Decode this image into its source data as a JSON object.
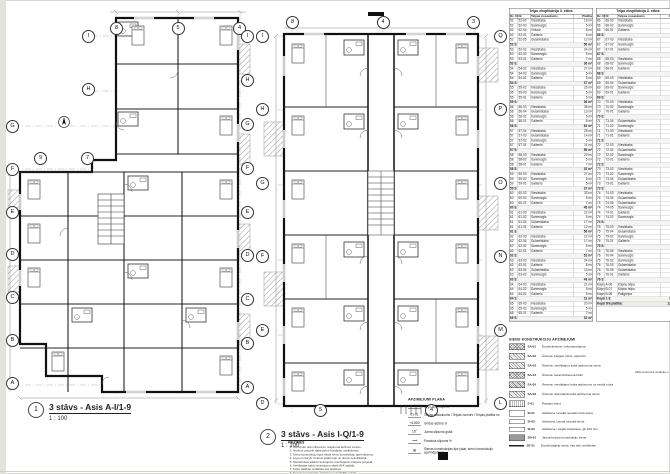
{
  "plan1": {
    "num": "1",
    "title": "3 stāvs - Asis A-I/1-9",
    "scale": "1 : 100",
    "bubbles_top": [
      "8",
      "5",
      "4"
    ],
    "bubbles_mid": [
      "9",
      "7"
    ],
    "bubbles_left_upper": [
      "I",
      "H"
    ],
    "bubbles_left": [
      "G",
      "F",
      "E",
      "D",
      "C",
      "B",
      "A"
    ],
    "bubbles_right": [
      "I",
      "H",
      "G",
      "F",
      "E",
      "D",
      "C",
      "B",
      "A"
    ]
  },
  "plan2": {
    "num": "2",
    "title": "3 stāvs - Asis I-Q/1-9",
    "scale": "1 : 100",
    "bubbles_top": [
      "8",
      "4",
      "3"
    ],
    "bubbles_left": [
      "I",
      "H",
      "G",
      "F",
      "E",
      "D"
    ],
    "bubbles_right": [
      "Q",
      "P",
      "O",
      "N",
      "M",
      "L"
    ],
    "bubbles_bottom": [
      "5",
      "4"
    ]
  },
  "tables": {
    "title": "Telpu eksplikācija 3. stāvs",
    "cols": [
      "Dz. Nr",
      "Nr",
      "Telpas nosaukums",
      "Platība"
    ],
    "rows1": [
      {
        "a": "52",
        "b": "52-02",
        "c": "Viesistaba",
        "d": "19 m²"
      },
      {
        "a": "52",
        "b": "52-03",
        "c": "Sanmezgls",
        "d": "5 m²"
      },
      {
        "a": "52",
        "b": "52-04",
        "c": "Virtuve",
        "d": "8 m²"
      },
      {
        "a": "52",
        "b": "52-01",
        "c": "Gaitenis",
        "d": "6 m²"
      },
      {
        "a": "52",
        "b": "52-05",
        "c": "Guļamistaba",
        "d": "12 m²"
      },
      {
        "a": "52 S:",
        "d": "50 m²",
        "t": "s"
      },
      {
        "a": "53",
        "b": "53-02",
        "c": "Viesistaba",
        "d": "24 m²"
      },
      {
        "a": "53",
        "b": "53-03",
        "c": "Sanmezgls",
        "d": "5 m²"
      },
      {
        "a": "53",
        "b": "53-01",
        "c": "Gaitenis",
        "d": "7 m²"
      },
      {
        "a": "53 S:",
        "d": "36 m²",
        "t": "s"
      },
      {
        "a": "54",
        "b": "54-02",
        "c": "Viesistaba",
        "d": "27 m²"
      },
      {
        "a": "54",
        "b": "54-03",
        "c": "Sanmezgls",
        "d": "5 m²"
      },
      {
        "a": "54",
        "b": "54-01",
        "c": "Gaitenis",
        "d": "5 m²"
      },
      {
        "a": "54 S:",
        "d": "37 m²",
        "t": "s"
      },
      {
        "a": "55",
        "b": "55-02",
        "c": "Viesistaba",
        "d": "26 m²"
      },
      {
        "a": "55",
        "b": "55-03",
        "c": "Sanmezgls",
        "d": "5 m²"
      },
      {
        "a": "55",
        "b": "55-01",
        "c": "Gaitenis",
        "d": "5 m²"
      },
      {
        "a": "55 S:",
        "d": "36 m²",
        "t": "s"
      },
      {
        "a": "56",
        "b": "56-03",
        "c": "Viesistaba",
        "d": "35 m²"
      },
      {
        "a": "56",
        "b": "56-04",
        "c": "Guļamistaba",
        "d": "13 m²"
      },
      {
        "a": "56",
        "b": "56-02",
        "c": "Sanmezgls",
        "d": "6 m²"
      },
      {
        "a": "56",
        "b": "56-01",
        "c": "Gaitenis",
        "d": "8 m²"
      },
      {
        "a": "56 S:",
        "d": "62 m²",
        "t": "s"
      },
      {
        "a": "57",
        "b": "57-04",
        "c": "Viesistaba",
        "d": "26 m²"
      },
      {
        "a": "57",
        "b": "57-03",
        "c": "Guļamistaba",
        "d": "14 m²"
      },
      {
        "a": "57",
        "b": "57-02",
        "c": "Sanmezgls",
        "d": "5 m²"
      },
      {
        "a": "57",
        "b": "57-01",
        "c": "Gaitenis",
        "d": "11 m²"
      },
      {
        "a": "57 S:",
        "d": "56 m²",
        "t": "s"
      },
      {
        "a": "58",
        "b": "58-03",
        "c": "Viesistaba",
        "d": "20 m²"
      },
      {
        "a": "58",
        "b": "58-02",
        "c": "Sanmezgls",
        "d": "5 m²"
      },
      {
        "a": "58",
        "b": "58-01",
        "c": "Gaitenis",
        "d": "7 m²"
      },
      {
        "a": "58 S:",
        "d": "32 m²",
        "t": "s"
      },
      {
        "a": "59",
        "b": "59-03",
        "c": "Viesistaba",
        "d": "27 m²"
      },
      {
        "a": "59",
        "b": "59-02",
        "c": "Sanmezgls",
        "d": "5 m²"
      },
      {
        "a": "59",
        "b": "59-01",
        "c": "Gaitenis",
        "d": "5 m²"
      },
      {
        "a": "59 S:",
        "d": "37 m²",
        "t": "s"
      },
      {
        "a": "60",
        "b": "60-03",
        "c": "Viesistaba",
        "d": "33 m²"
      },
      {
        "a": "60",
        "b": "60-02",
        "c": "Sanmezgls",
        "d": "5 m²"
      },
      {
        "a": "60",
        "b": "60-01",
        "c": "Gaitenis",
        "d": "7 m²"
      },
      {
        "a": "60 S:",
        "d": "45 m²",
        "t": "s"
      },
      {
        "a": "61",
        "b": "61-03",
        "c": "Viesistaba",
        "d": "22 m²"
      },
      {
        "a": "61",
        "b": "61-02",
        "c": "Sanmezgls",
        "d": "5 m²"
      },
      {
        "a": "61",
        "b": "61-04",
        "c": "Guļamistaba",
        "d": "17 m²"
      },
      {
        "a": "61",
        "b": "61-01",
        "c": "Gaitenis",
        "d": "12 m²"
      },
      {
        "a": "61 S:",
        "d": "56 m²",
        "t": "s"
      },
      {
        "a": "62",
        "b": "62-03",
        "c": "Viesistaba",
        "d": "22 m²"
      },
      {
        "a": "62",
        "b": "62-04",
        "c": "Guļamistaba",
        "d": "17 m²"
      },
      {
        "a": "62",
        "b": "62-02",
        "c": "Sanmezgls",
        "d": "5 m²"
      },
      {
        "a": "62",
        "b": "62-01",
        "c": "Gaitenis",
        "d": "7 m²"
      },
      {
        "a": "62 S:",
        "d": "51 m²",
        "t": "s"
      },
      {
        "a": "63",
        "b": "63-03",
        "c": "Viesistaba",
        "d": "24 m²"
      },
      {
        "a": "63",
        "b": "63-01",
        "c": "Gaitenis",
        "d": "8 m²"
      },
      {
        "a": "63",
        "b": "63-04",
        "c": "Guļamistaba",
        "d": "13 m²"
      },
      {
        "a": "63",
        "b": "63-02",
        "c": "Sanmezgls",
        "d": "5 m²"
      },
      {
        "a": "63 S:",
        "d": "49 m²",
        "t": "s"
      },
      {
        "a": "64",
        "b": "64-03",
        "c": "Viesistaba",
        "d": "21 m²"
      },
      {
        "a": "64",
        "b": "64-02",
        "c": "Sanmezgls",
        "d": "5 m²"
      },
      {
        "a": "64",
        "b": "64-01",
        "c": "Gaitenis",
        "d": "5 m²"
      },
      {
        "a": "64 S:",
        "d": "31 m²",
        "t": "s"
      },
      {
        "a": "65",
        "b": "65-03",
        "c": "Viesistaba",
        "d": "20 m²"
      },
      {
        "a": "65",
        "b": "65-02",
        "c": "Sanmezgls",
        "d": "5 m²"
      },
      {
        "a": "65",
        "b": "65-01",
        "c": "Gaitenis",
        "d": "7 m²"
      },
      {
        "a": "65 S:",
        "d": "32 m²",
        "t": "s"
      }
    ],
    "rows2": [
      {
        "a": "66",
        "b": "66-03",
        "c": "Viesistaba",
        "d": "20 m²"
      },
      {
        "a": "66",
        "b": "66-02",
        "c": "Sanmezgls",
        "d": "5 m²"
      },
      {
        "a": "66",
        "b": "66-01",
        "c": "Gaitenis",
        "d": "7 m²"
      },
      {
        "a": "66 S:",
        "d": "32 m²",
        "t": "s"
      },
      {
        "a": "67",
        "b": "67-03",
        "c": "Viesistaba",
        "d": "16 m²"
      },
      {
        "a": "67",
        "b": "67-02",
        "c": "Sanmezgls",
        "d": "4 m²"
      },
      {
        "a": "67",
        "b": "67-01",
        "c": "Gaitenis",
        "d": "3 m²"
      },
      {
        "a": "67 S:",
        "d": "23 m²",
        "t": "s"
      },
      {
        "a": "68",
        "b": "68-03",
        "c": "Viesistaba",
        "d": "19 m²"
      },
      {
        "a": "68",
        "b": "68-02",
        "c": "Sanmezgls",
        "d": "4 m²"
      },
      {
        "a": "68",
        "b": "68-01",
        "c": "Gaitenis",
        "d": "4 m²"
      },
      {
        "a": "68 S:",
        "d": "27 m²",
        "t": "s"
      },
      {
        "a": "69",
        "b": "69-03",
        "c": "Viesistaba",
        "d": "23 m²"
      },
      {
        "a": "69",
        "b": "69-04",
        "c": "Guļamistaba",
        "d": "11 m²"
      },
      {
        "a": "69",
        "b": "69-02",
        "c": "Sanmezgls",
        "d": "4 m²"
      },
      {
        "a": "69",
        "b": "69-01",
        "c": "Gaitenis",
        "d": "5 m²"
      },
      {
        "a": "69 S:",
        "d": "43 m²",
        "t": "s"
      },
      {
        "a": "70",
        "b": "70-03",
        "c": "Viesistaba",
        "d": "26 m²"
      },
      {
        "a": "70",
        "b": "70-02",
        "c": "Sanmezgls",
        "d": "4 m²"
      },
      {
        "a": "70",
        "b": "70-01",
        "c": "Gaitenis",
        "d": "5 m²"
      },
      {
        "a": "70 S:",
        "d": "35 m²",
        "t": "s"
      },
      {
        "a": "71",
        "b": "71-04",
        "c": "Guļamistaba",
        "d": "13 m²"
      },
      {
        "a": "71",
        "b": "71-02",
        "c": "Sanmezgls",
        "d": "4 m²"
      },
      {
        "a": "71",
        "b": "71-03",
        "c": "Viesistaba",
        "d": "24 m²"
      },
      {
        "a": "71",
        "b": "71-01",
        "c": "Gaitenis",
        "d": "4 m²"
      },
      {
        "a": "71 S:",
        "d": "45 m²",
        "t": "s"
      },
      {
        "a": "72",
        "b": "72-03",
        "c": "Viesistaba",
        "d": "24 m²"
      },
      {
        "a": "72",
        "b": "72-04",
        "c": "Guļamistaba",
        "d": "12 m²"
      },
      {
        "a": "72",
        "b": "72-02",
        "c": "Sanmezgls",
        "d": "5 m²"
      },
      {
        "a": "72",
        "b": "72-01",
        "c": "Gaitenis",
        "d": "6 m²"
      },
      {
        "a": "72 S:",
        "d": "47 m²",
        "t": "s"
      },
      {
        "a": "73",
        "b": "73-03",
        "c": "Viesistaba",
        "d": "26 m²"
      },
      {
        "a": "73",
        "b": "73-02",
        "c": "Sanmezgls",
        "d": "4 m²"
      },
      {
        "a": "73",
        "b": "73-04",
        "c": "Guļamistaba",
        "d": "11 m²"
      },
      {
        "a": "73",
        "b": "73-01",
        "c": "Gaitenis",
        "d": "5 m²"
      },
      {
        "a": "73 S:",
        "d": "46 m²",
        "t": "s"
      },
      {
        "a": "74",
        "b": "74-03",
        "c": "Viesistaba",
        "d": "24 m²"
      },
      {
        "a": "74",
        "b": "74-04",
        "c": "Guļamistaba",
        "d": "13 m²"
      },
      {
        "a": "74",
        "b": "74-06",
        "c": "Guļamistaba",
        "d": "12 m²"
      },
      {
        "a": "74",
        "b": "74-05",
        "c": "Sanmezgls",
        "d": "5 m²"
      },
      {
        "a": "74",
        "b": "74-01",
        "c": "Gaitenis",
        "d": "8 m²"
      },
      {
        "a": "74",
        "b": "74-02",
        "c": "Sanmezgls",
        "d": "4 m²"
      },
      {
        "a": "74 S:",
        "d": "66 m²",
        "t": "s"
      },
      {
        "a": "75",
        "b": "75-03",
        "c": "Viesistaba",
        "d": "25 m²"
      },
      {
        "a": "75",
        "b": "75-04",
        "c": "Guļamistaba",
        "d": "11 m²"
      },
      {
        "a": "75",
        "b": "75-02",
        "c": "Sanmezgls",
        "d": "4 m²"
      },
      {
        "a": "75",
        "b": "75-01",
        "c": "Gaitenis",
        "d": "5 m²"
      },
      {
        "a": "75 S:",
        "d": "45 m²",
        "t": "s"
      },
      {
        "a": "76",
        "b": "76-06",
        "c": "Viesistaba",
        "d": "24 m²"
      },
      {
        "a": "76",
        "b": "76-04",
        "c": "Sanmezgls",
        "d": "4 m²"
      },
      {
        "a": "76",
        "b": "76-02",
        "c": "Sanmezgls",
        "d": "4 m²"
      },
      {
        "a": "76",
        "b": "76-03",
        "c": "Guļamistaba",
        "d": "12 m²"
      },
      {
        "a": "76",
        "b": "76-05",
        "c": "Guļamistaba",
        "d": "9 m²"
      },
      {
        "a": "76",
        "b": "76-01",
        "c": "Gaitenis",
        "d": "8 m²"
      },
      {
        "a": "76 S:",
        "d": "61 m²",
        "t": "s"
      },
      {
        "a": "Kāpņi",
        "b": "A-06",
        "c": "Kāpņu telpa",
        "d": "62 m²"
      },
      {
        "a": "Kāpņi",
        "b": "B-07",
        "c": "Kāpņu telpa",
        "d": "73 m²"
      },
      {
        "a": "Kāpņi",
        "b": "B-08",
        "c": "Palīgtelpa",
        "d": "8 m²"
      },
      {
        "a": "Kopā 1-3:",
        "d": "143 m²",
        "t": "s"
      },
      {
        "a": "Kopā tīrā platība:",
        "d": "1293 m²",
        "t": "t2"
      }
    ]
  },
  "legend": {
    "title": "SIENU KONSTRUKCIJU APZĪMĒJUMI",
    "note": "Siltā perimetra izolācija: min 150",
    "items": [
      {
        "code": "SA-01",
        "sw": "hbrick",
        "text": "Esošā ārsiena / rekonstruējama"
      },
      {
        "code": "SA-02",
        "sw": "hdiag",
        "text": "Ārsiena: ķieģeļu mūris, apmests"
      },
      {
        "code": "SA-03",
        "sw": "hdiag",
        "text": "Ārsiena: ventilējama koka apšuvuma siena"
      },
      {
        "code": "SA-04",
        "sw": "hbrick",
        "text": "Ārsiena: keramzītbetona bloki"
      },
      {
        "code": "SA-05",
        "sw": "hdense",
        "text": "Ārsiena: ventilējams koka apšuvums uz esošā mūra"
      },
      {
        "code": "SA-06",
        "sw": "hdiag",
        "text": "Ārsiena: dekoratīvā koka apšuvuma siena"
      },
      {
        "code": "S-01",
        "sw": "dots",
        "text": "Pamatu siena"
      },
      {
        "code": "SI-01",
        "sw": "plain",
        "text": "Iekšsiena / esošā nesošā mūra siena"
      },
      {
        "code": "SI-02",
        "sw": "plain thin",
        "text": "Iekšsiena / jaunā nesošā siena"
      },
      {
        "code": "SI-03",
        "sw": "plain thin",
        "text": "Iekšsiena / vieglā starpsiena, ģk 100 mm"
      },
      {
        "code": "SB-01",
        "sw": "solid",
        "text": "Jaunā betona konstrukciju siena"
      },
      {
        "code": "SE-01",
        "sw": "line",
        "text": "Esošā ķieģeļu siena, kas tiek nosiltināta"
      }
    ]
  },
  "symbols": {
    "title": "APZĪMĒJUMI PLĀNĀ",
    "items": [
      {
        "sym": "⊕",
        "label": "Logu apzīmējums"
      },
      {
        "sym": "01-01",
        "label": "Telpas nosaukums / Telpas numurs / Telpas platība m²"
      },
      {
        "sym": "+4.500",
        "label": "Grīdas atzīme m"
      },
      {
        "sym": "15°",
        "label": "Jumta slīpuma grādi"
      },
      {
        "sym": "⟶",
        "label": "Pandusa slīpums %"
      },
      {
        "sym": "⊠",
        "label": "Sienas konstrukcijas tips (skat. sienu konstrukciju apzīmējumus)"
      }
    ]
  },
  "notes": {
    "title": "PIEZĪMES",
    "items": [
      "Visi izmēri doti milimetros, augstuma atzīmes metros.",
      "Izmērus precizēt dabā pirms būvdarbu uzsākšanas.",
      "Sienu konstrukciju tipus skatīt sienu konstrukciju apzīmējumos.",
      "Logu un durvju izmērus skatīt logu un durvju specifikācijā.",
      "Santehnikas iekārtu izvietojums precizējams interjera projektā.",
      "Ventilācijas šahtu izvietojumu skatīt AVK sadaļā.",
      "Telpu platības norādītas pēc apdares.",
      "Nesošo konstrukciju risinājumus skatīt BK sadaļā.",
      "Pirms darbu veikšanas saskaņot ar autoruzraugu."
    ]
  }
}
